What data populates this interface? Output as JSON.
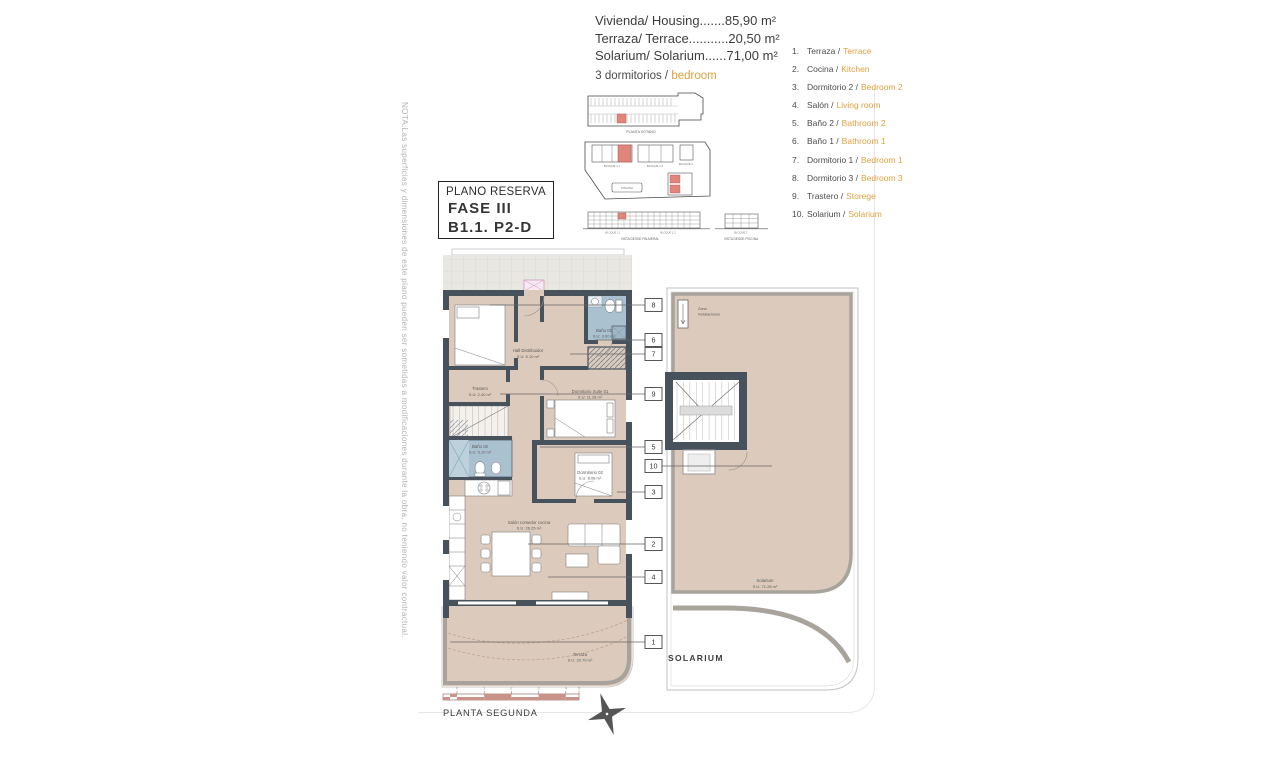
{
  "colors": {
    "accent_orange": "#dfa041",
    "highlight_red": "#e0857a",
    "wall": "#47525d",
    "floor_tan": "#dccbbc",
    "bath_blue": "#aac2d0",
    "scale_pink": "#c9938a"
  },
  "summary": {
    "housing": "Vivienda/ Housing.......85,90 m²",
    "terrace": "Terraza/ Terrace...........20,50 m²",
    "solarium": "Solarium/ Solarium......71,00 m²",
    "bedrooms_prefix": "3 dormitorios /",
    "bedrooms_highlight": "bedroom"
  },
  "title_box": {
    "line1": "PLANO RESERVA",
    "line2": "FASE III",
    "line3": "B1.1. P2-D"
  },
  "side_note": "NOTA:Las superficies y dimensiones de este plano pueden ser sometidas a modificaciones durante la obra, no teniendo valor contractual.",
  "legend": {
    "items": [
      {
        "n": "1.",
        "es": "Terraza /",
        "en": "Terrace"
      },
      {
        "n": "2.",
        "es": "Cocina /",
        "en": "Kitchen"
      },
      {
        "n": "3.",
        "es": "Dormitorio 2 /",
        "en": "Bedroom 2"
      },
      {
        "n": "4.",
        "es": "Salón /",
        "en": "Living room"
      },
      {
        "n": "5.",
        "es": "Baño 2 /",
        "en": "Bathroom 2"
      },
      {
        "n": "6.",
        "es": "Baño 1 /",
        "en": "Bathroom 1"
      },
      {
        "n": "7.",
        "es": "Dormitorio 1 /",
        "en": "Bedroom 1"
      },
      {
        "n": "8.",
        "es": "Dormitorio 3 /",
        "en": "Bedroom 3"
      },
      {
        "n": "9.",
        "es": "Trastero /",
        "en": "Storege"
      },
      {
        "n": "10.",
        "es": "Solarium /",
        "en": "Solarium"
      }
    ]
  },
  "plan": {
    "rooms": {
      "hall": {
        "name": "Hall Distribuidor",
        "area": "S.U: 5.10 m²"
      },
      "trastero": {
        "name": "Trastero",
        "area": "S.U: 2.40 m²"
      },
      "bano1": {
        "name": "Baño 01",
        "area": "S.U: 3.60 m²"
      },
      "suite": {
        "name": "Dormitorio Suite 01",
        "area": "S.U: 11.28 m²"
      },
      "bano2": {
        "name": "Baño 02",
        "area": "S.U: 5.10 m²"
      },
      "dorm2": {
        "name": "Dormitorio 02",
        "area": "S.U: 8.08 m²"
      },
      "salon": {
        "name": "Salón comedor cocina",
        "area": "S.U: 26.25 m²"
      },
      "terraza": {
        "name": "Terraza",
        "area": "S.U: 20.70 m²"
      }
    },
    "callouts": [
      "8",
      "6",
      "7",
      "9",
      "5",
      "10",
      "3",
      "2",
      "4",
      "1"
    ]
  },
  "solarium_plan": {
    "zona_line1": "Zona",
    "zona_line2": "Instalaciones",
    "room": "Solarium",
    "area": "S.U: 71.28 m²",
    "caption": "SOLARIUM"
  },
  "site": {
    "garage_caption": "PLANTA SÓTANO",
    "block11": "BLOQUE 1.1",
    "block12": "BLOQUE 1.2",
    "block2": "BLOQUE 2",
    "piscina": "PISCINA",
    "elev_block11": "BLOQUE 1.1",
    "elev_block12": "BLOQUE 1.2",
    "elev_block2": "BLOQUE 2",
    "elev_caption_left": "VISTA DESDE PALMERAL",
    "elev_caption_right": "VISTA DESDE PISCINA"
  },
  "footer": {
    "floor_label": "PLANTA SEGUNDA",
    "scale_ticks": [
      "0",
      "1",
      "2",
      "3",
      "4",
      "5"
    ]
  }
}
